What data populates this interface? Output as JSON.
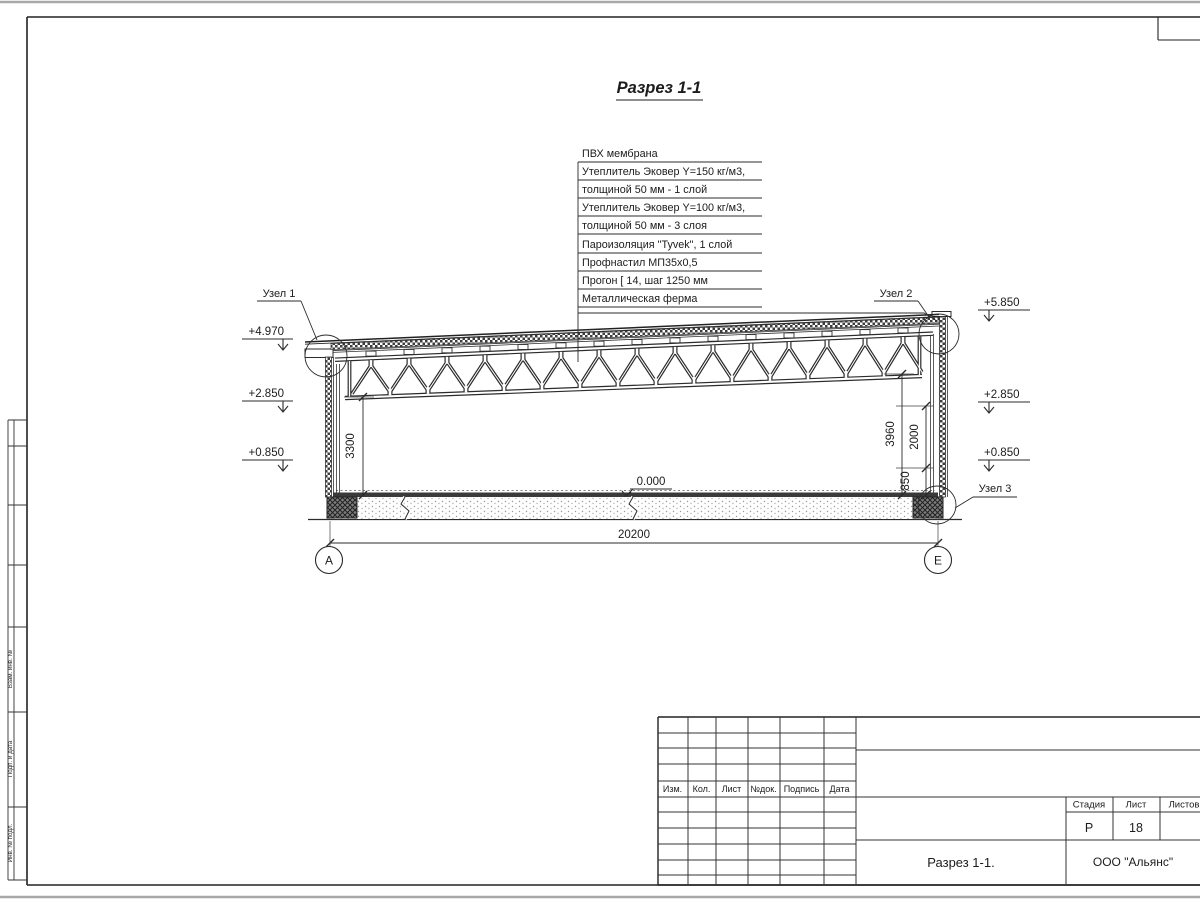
{
  "sheet": {
    "title": "Разрез 1-1"
  },
  "callout": {
    "lines": [
      "ПВХ мембрана",
      "Утеплитель Эковер Y=150 кг/м3,",
      "толщиной 50 мм - 1 слой",
      "Утеплитель Эковер Y=100 кг/м3,",
      "толщиной 50 мм - 3 слоя",
      "Пароизоляция \"Tyvek\", 1 слой",
      "Профнастил МП35х0,5",
      "Прогон [ 14, шаг 1250 мм",
      "Металлическая ферма"
    ]
  },
  "nodes": {
    "n1": "Узел 1",
    "n2": "Узел 2",
    "n3": "Узел 3"
  },
  "elevations": {
    "left_top": "+4.970",
    "left_mid": "+2.850",
    "left_low": "+0.850",
    "right_top": "+5.850",
    "right_mid": "+2.850",
    "right_low": "+0.850",
    "zero": "0.000"
  },
  "dimensions": {
    "span": "20200",
    "left_height": "3300",
    "right_total": "3960",
    "right_upper": "2000",
    "right_lower": "850"
  },
  "axes": {
    "left": "А",
    "right": "Е"
  },
  "titleblock": {
    "headers": [
      "Изм.",
      "Кол.",
      "Лист",
      "№док.",
      "Подпись",
      "Дата"
    ],
    "stage_label": "Стадия",
    "sheet_label": "Лист",
    "sheets_label": "Листов",
    "stage": "Р",
    "sheet_number": "18",
    "doc_title": "Разрез 1-1.",
    "company": "ООО \"Альянс\""
  },
  "margin": {
    "labels": [
      "Взам. инв. №",
      "Подп. и дата",
      "Инв. № подл."
    ]
  }
}
